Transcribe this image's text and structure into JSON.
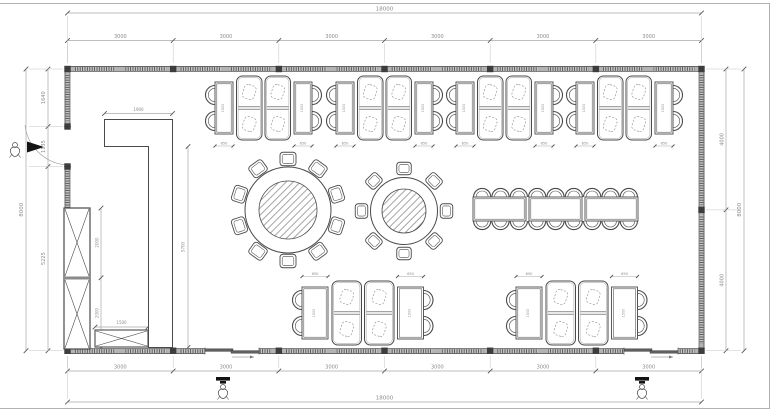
{
  "drawing": {
    "type_label": "furniture-floor-plan",
    "colors": {
      "line": "#4a4a4a",
      "wall_fill": "#b3b3b3",
      "wall_edge": "#5a5a5a",
      "dim_line": "#a8a8a8",
      "dim_text": "#8b8b8b",
      "hatch": "#4e4e4e",
      "door_leaf": "#5f5f5f",
      "black": "#141414"
    }
  },
  "dimensions": {
    "top_overall": "18000",
    "top_segments": [
      "3000",
      "3000",
      "3000",
      "3000",
      "3000",
      "3000"
    ],
    "bottom_overall": "18000",
    "bottom_segments": [
      "3000",
      "3000",
      "3000",
      "3000",
      "3000",
      "3000"
    ],
    "left_overall": "8000",
    "left_segments": [
      "1640",
      "1135",
      "5225"
    ],
    "right_overall": "8000",
    "right_segments": [
      "4000",
      "4000"
    ]
  },
  "interior_dimensions": {
    "partition_width": "1900",
    "partition_height": "5700",
    "cabinet_upper": "2000",
    "cabinet_lower": "2000",
    "counter_width": "1500",
    "booth_table_width": "650",
    "booth_table_length": "1500"
  },
  "furniture": {
    "top_booth_groups": 4,
    "bottom_booth_groups": 2,
    "round_table_large_chairs": 10,
    "round_table_small_chairs": 8,
    "long_table_sections": 3,
    "long_table_chairs_per_side": 9,
    "entry_figures": 3,
    "wall_cabinet_sections": 2
  }
}
